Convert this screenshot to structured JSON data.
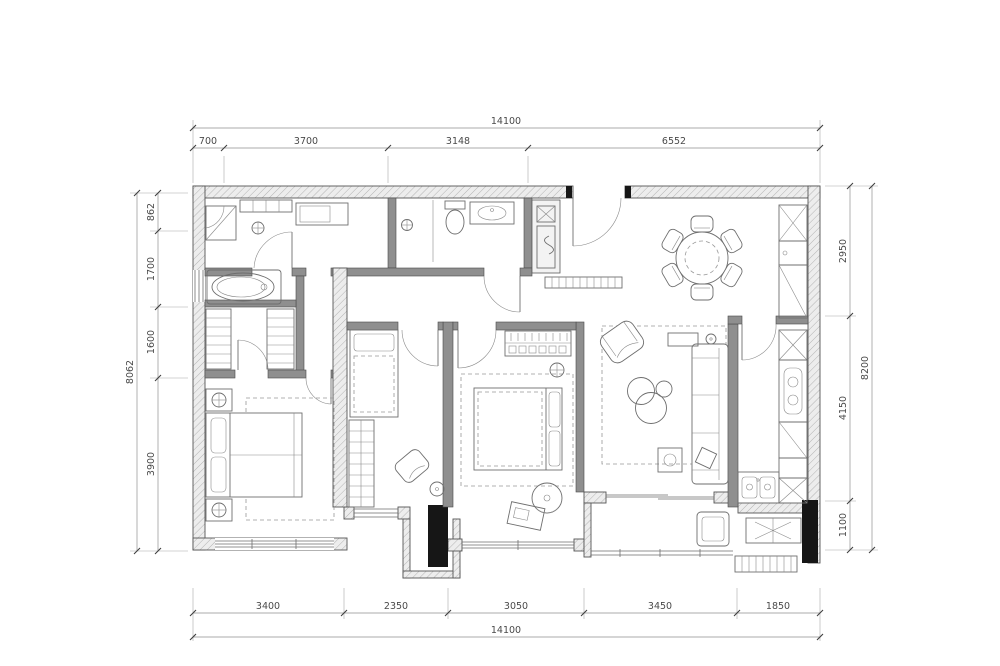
{
  "drawing": {
    "type": "apartment-floor-plan",
    "colors": {
      "background": "#ffffff",
      "wall_line": "#555555",
      "wall_hatch_fill": "#ededed",
      "interior_wall_fill": "#8f8f8f",
      "furniture_line": "#6e6e6e",
      "dimension_line": "#8f8f8f",
      "dimension_text": "#4a4a4a",
      "structural_black": "#161616"
    },
    "dimensions_mm": {
      "top": {
        "overall": "14100",
        "segments": [
          "700",
          "3700",
          "3148",
          "6552"
        ]
      },
      "bottom": {
        "overall": "14100",
        "segments": [
          "3400",
          "2350",
          "3050",
          "3450",
          "1850"
        ]
      },
      "left": {
        "overall": "8062",
        "segments": [
          "862",
          "1700",
          "1600",
          "3900"
        ]
      },
      "right": {
        "overall": "8200",
        "segments": [
          "2950",
          "4150",
          "1100"
        ]
      }
    }
  }
}
